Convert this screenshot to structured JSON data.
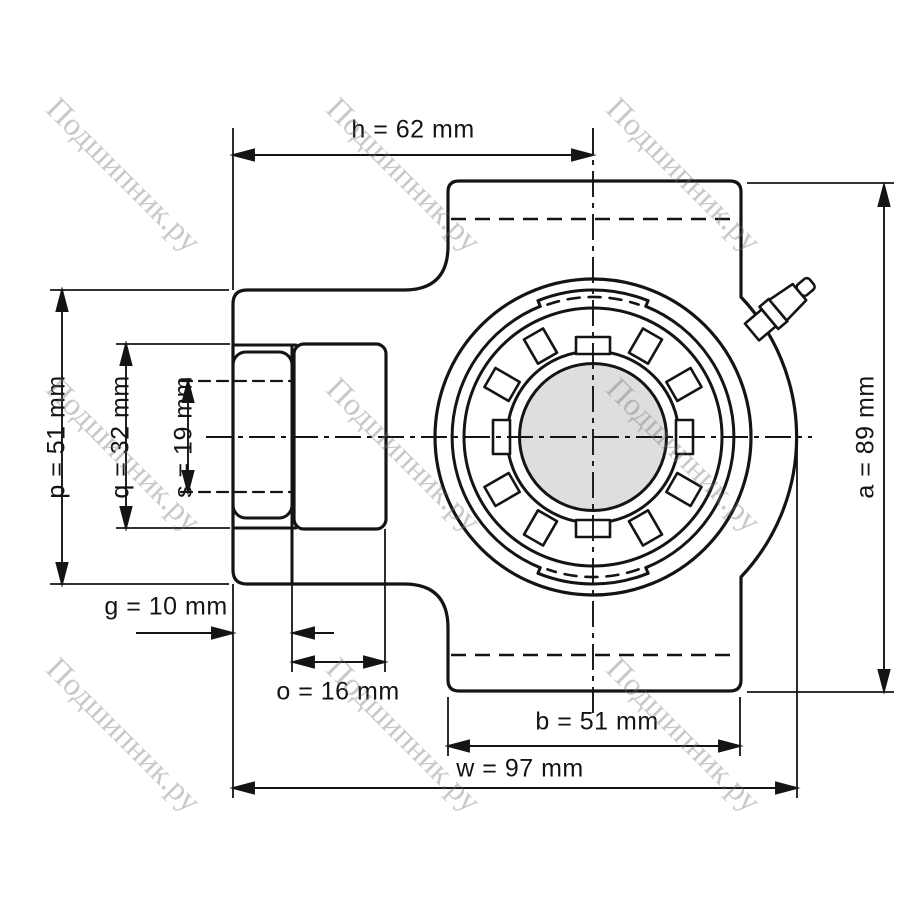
{
  "part": {
    "description": "Take-up (tension) bearing unit — front view technical drawing",
    "view": "axial front view with shaft cross-section"
  },
  "watermark": {
    "text": "Подшипник.ру"
  },
  "dims": {
    "h": "h = 62 mm",
    "p": "p = 51 mm",
    "q": "q = 32 mm",
    "s": "s = 19 mm",
    "g": "g = 10 mm",
    "o": "o = 16 mm",
    "b": "b = 51 mm",
    "w": "w = 97 mm",
    "a": "a = 89 mm"
  },
  "dimensions_mm": {
    "h": 62,
    "p": 51,
    "q": 32,
    "s": 19,
    "g": 10,
    "o": 16,
    "b": 51,
    "w": 97,
    "a": 89
  },
  "colors": {
    "line": "#141414",
    "shaft_fill": "#dedede",
    "watermark": "#6e6e6e",
    "background": "#ffffff"
  }
}
